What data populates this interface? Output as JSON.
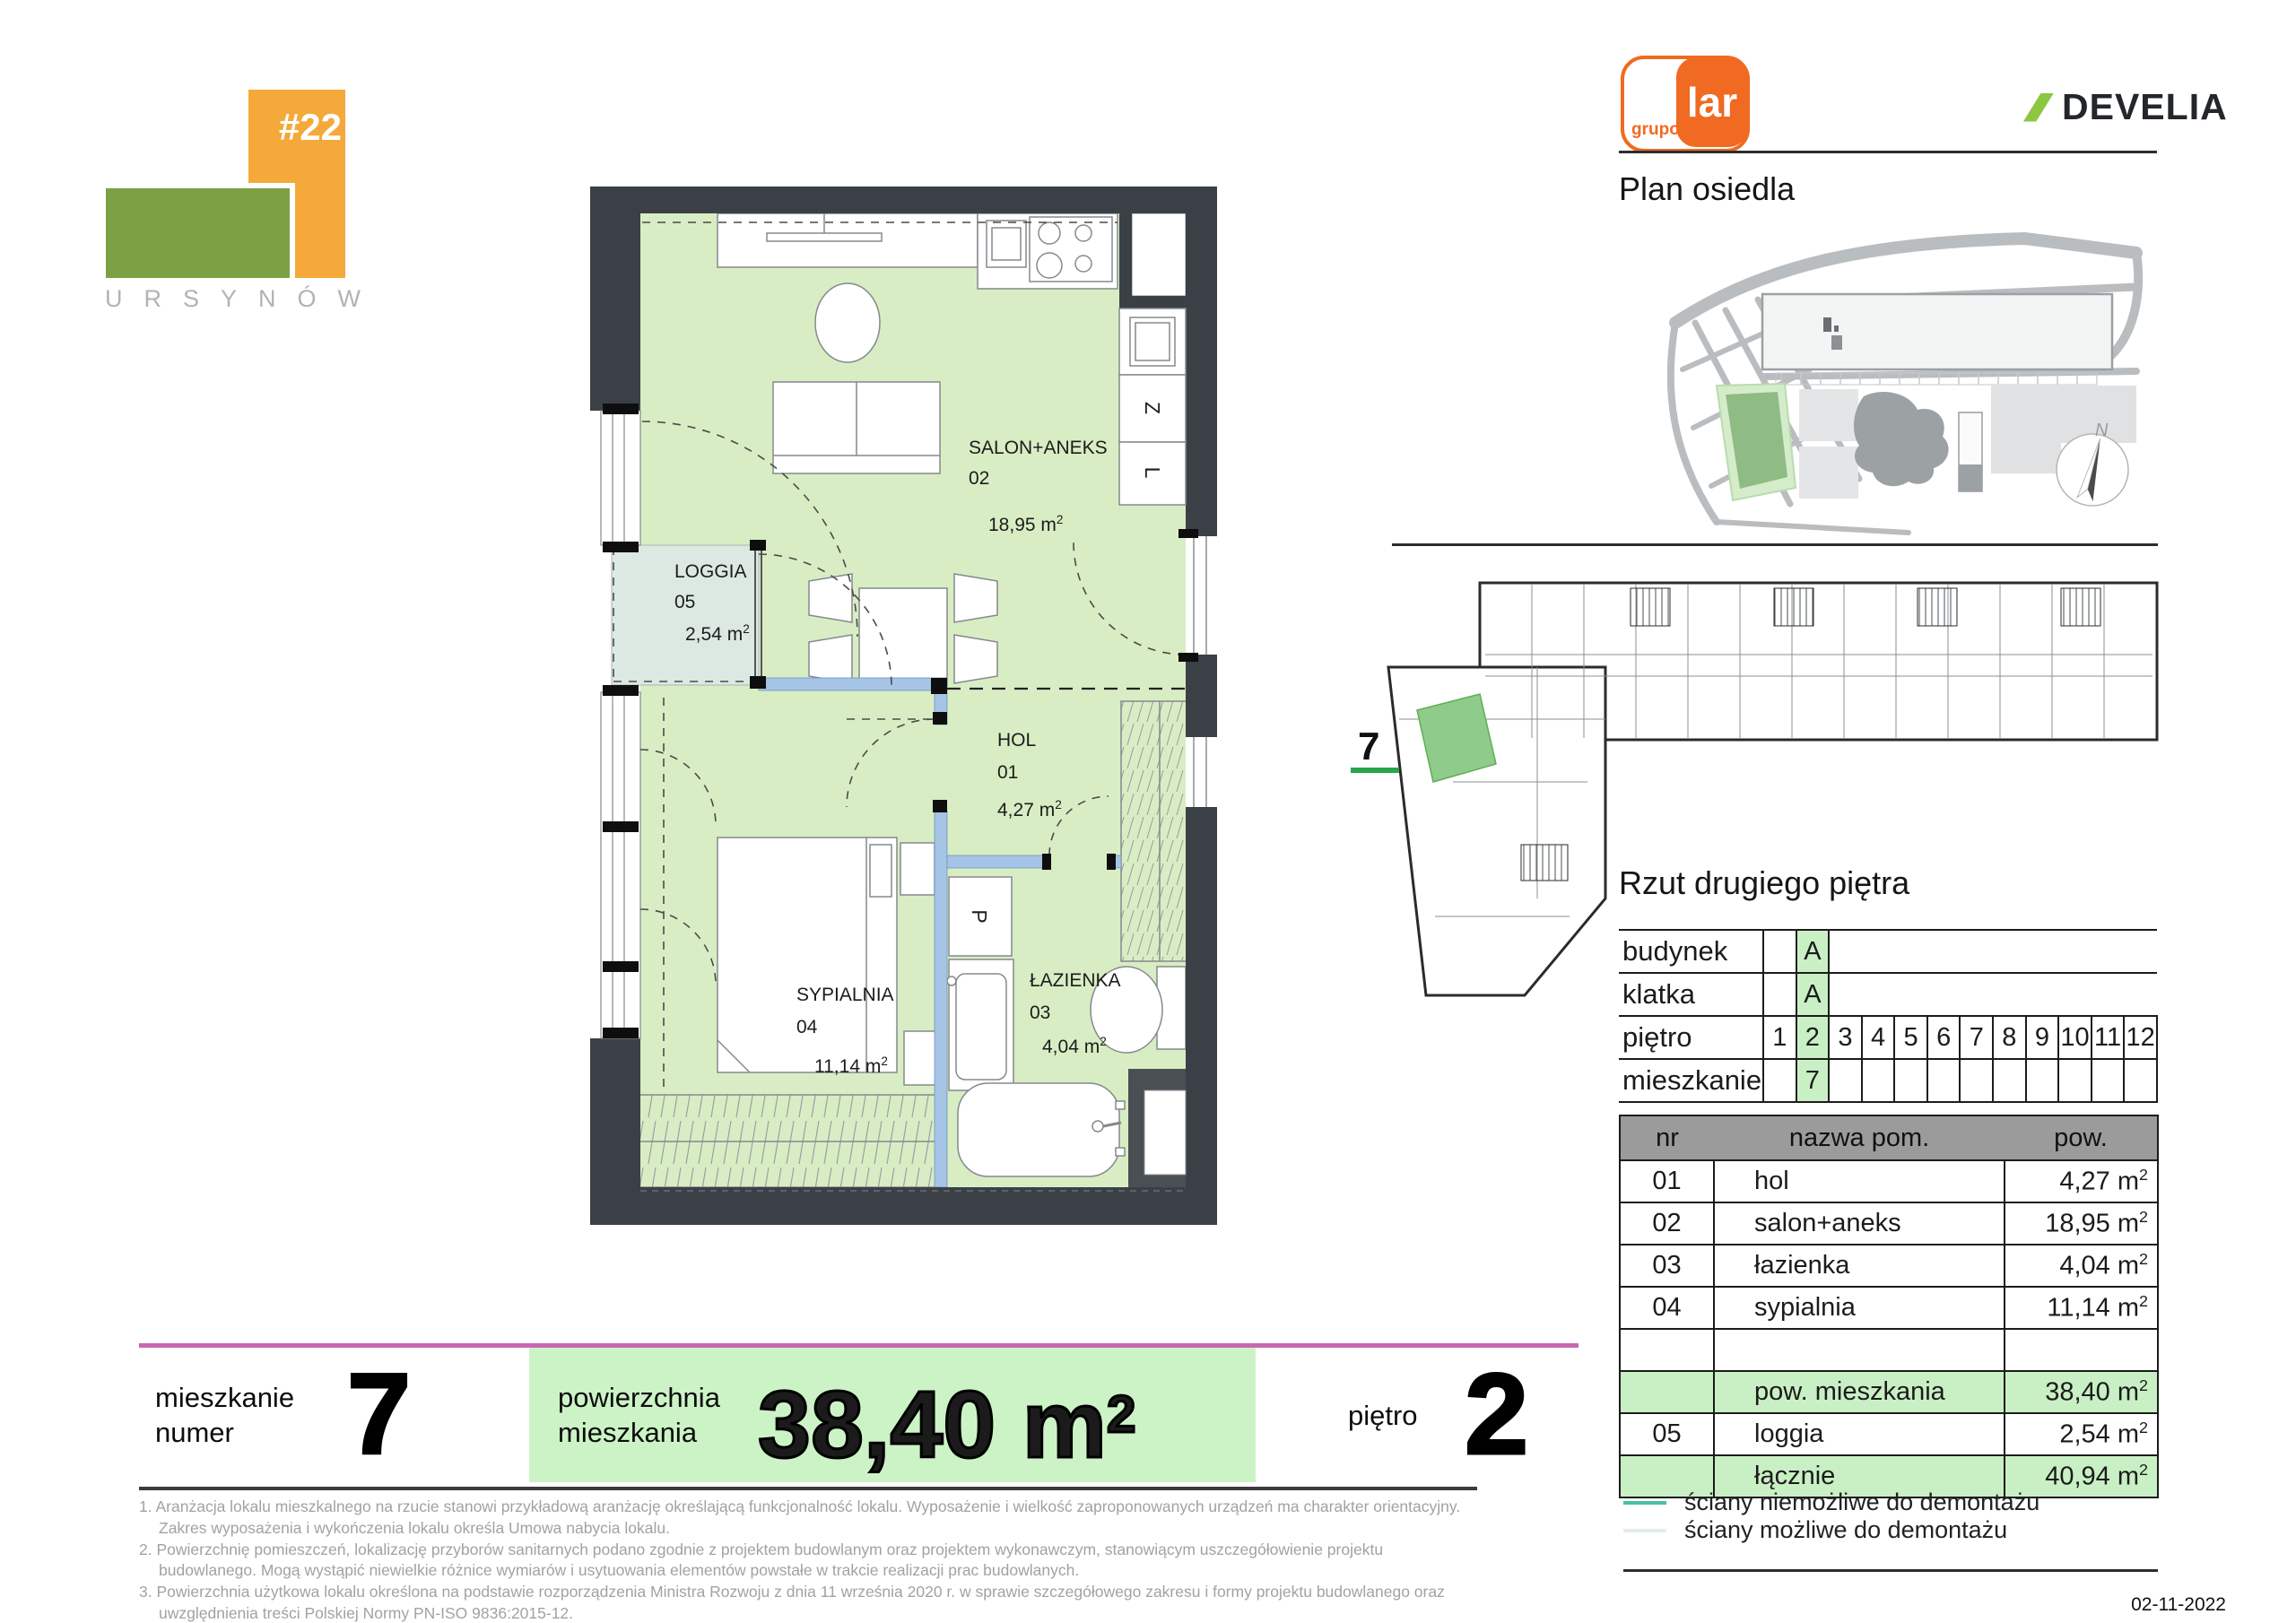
{
  "page": {
    "date": "02-11-2022"
  },
  "project_logo": {
    "number": "#22",
    "name": "URSYNÓW"
  },
  "brands": {
    "grupo_lar": {
      "grupo": "grupo",
      "lar": "lar"
    },
    "develia": "DEVELIA"
  },
  "estate_plan": {
    "title": "Plan osiedla",
    "compass_north": "N"
  },
  "floor_plan_mini": {
    "marker": "7"
  },
  "floor_view": {
    "title": "Rzut drugiego piętra"
  },
  "unit_info_table": {
    "building_label": "budynek",
    "building_value": "A",
    "staircase_label": "klatka",
    "staircase_value": "A",
    "floor_label": "piętro",
    "floors": [
      "1",
      "2",
      "3",
      "4",
      "5",
      "6",
      "7",
      "8",
      "9",
      "10",
      "11",
      "12"
    ],
    "selected_floor": "2",
    "apartment_label": "mieszkanie",
    "apartment_value": "7"
  },
  "rooms_table": {
    "headers": {
      "nr": "nr",
      "name": "nazwa pom.",
      "area": "pow."
    },
    "rows": [
      {
        "nr": "01",
        "name": "hol",
        "area": "4,27",
        "highlight": false
      },
      {
        "nr": "02",
        "name": "salon+aneks",
        "area": "18,95",
        "highlight": false
      },
      {
        "nr": "03",
        "name": "łazienka",
        "area": "4,04",
        "highlight": false
      },
      {
        "nr": "04",
        "name": "sypialnia",
        "area": "11,14",
        "highlight": false
      },
      {
        "nr": "",
        "name": "",
        "area": "",
        "highlight": false
      },
      {
        "nr": "",
        "name": "pow. mieszkania",
        "area": "38,40",
        "highlight": true
      },
      {
        "nr": "05",
        "name": "loggia",
        "area": "2,54",
        "highlight": false
      },
      {
        "nr": "",
        "name": "łącznie",
        "area": "40,94",
        "highlight": true
      }
    ]
  },
  "legend": {
    "items": [
      {
        "label": "ściany niemożliwe do demontażu",
        "color": "#4cc0a0"
      },
      {
        "label": "ściany możliwe do demontażu",
        "color": "#e2efe9"
      }
    ]
  },
  "summary_bar": {
    "apartment_label_line1": "mieszkanie",
    "apartment_label_line2": "numer",
    "apartment_number": "7",
    "area_label_line1": "powierzchnia",
    "area_label_line2": "mieszkania",
    "area_value": "38,40",
    "floor_label": "piętro",
    "floor_value": "2"
  },
  "footnotes": [
    "1. Aranżacja lokalu mieszkalnego na rzucie stanowi przykładową aranżację określającą funkcjonalność lokalu. Wyposażenie i wielkość zaproponowanych urządzeń ma charakter orientacyjny. Zakres wyposażenia i wykończenia lokalu określa Umowa nabycia lokalu.",
    "2. Powierzchnię pomieszczeń, lokalizację przyborów sanitarnych podano zgodnie z projektem budowlanym oraz projektem wykonawczym, stanowiącym uszczegółowienie projektu budowlanego. Mogą wystąpić niewielkie różnice wymiarów i usytuowania elementów powstałe w trakcie realizacji prac budowlanych.",
    "3. Powierzchnia użytkowa lokalu określona na podstawie rozporządzenia Ministra Rozwoju z dnia 11 września 2020 r. w sprawie szczegółowego zakresu i formy projektu budowlanego oraz uwzględnienia treści Polskiej Normy PN-ISO 9836:2015-12.",
    "4. Do powierzchni użytkowej lokalu nie wlicza się powierzchni elementów nadających się do demontażu np. ścianek działowych. Podane wymiary są wymiarami w świetle pionowych przegród (ścian) w stanie surowym, nie uwzględniają wykończenia tynkiem.",
    "5. informacje na karcie nie stanowią oferty handlowej w rozumieniu art. 60 kodeksu cywilnego."
  ],
  "floor_plan": {
    "rooms": {
      "salon": {
        "name": "SALON+ANEKS",
        "number": "02",
        "area": "18,95"
      },
      "loggia": {
        "name": "LOGGIA",
        "number": "05",
        "area": "2,54"
      },
      "hol": {
        "name": "HOL",
        "number": "01",
        "area": "4,27"
      },
      "sypialnia": {
        "name": "SYPIALNIA",
        "number": "04",
        "area": "11,14"
      },
      "lazienka": {
        "name": "ŁAZIENKA",
        "number": "03",
        "area": "4,04"
      }
    },
    "appliances": {
      "dishwasher": "Z",
      "fridge": "L",
      "washer": "P"
    }
  },
  "area_unit": {
    "base": "m",
    "exp": "2"
  },
  "colors": {
    "accent_green_fill": "#c9f0c4",
    "plan_room_green": "#d9edc4",
    "plan_loggia": "#dbe9e2",
    "plan_demountable_wall_blue": "#a6c4e5",
    "wall_dark": "#3b4046",
    "summary_pink_line": "#c967b1",
    "brand_orange": "#f06a22",
    "develia_green": "#8dc63f",
    "marker_underline_green": "#2aa64a"
  }
}
